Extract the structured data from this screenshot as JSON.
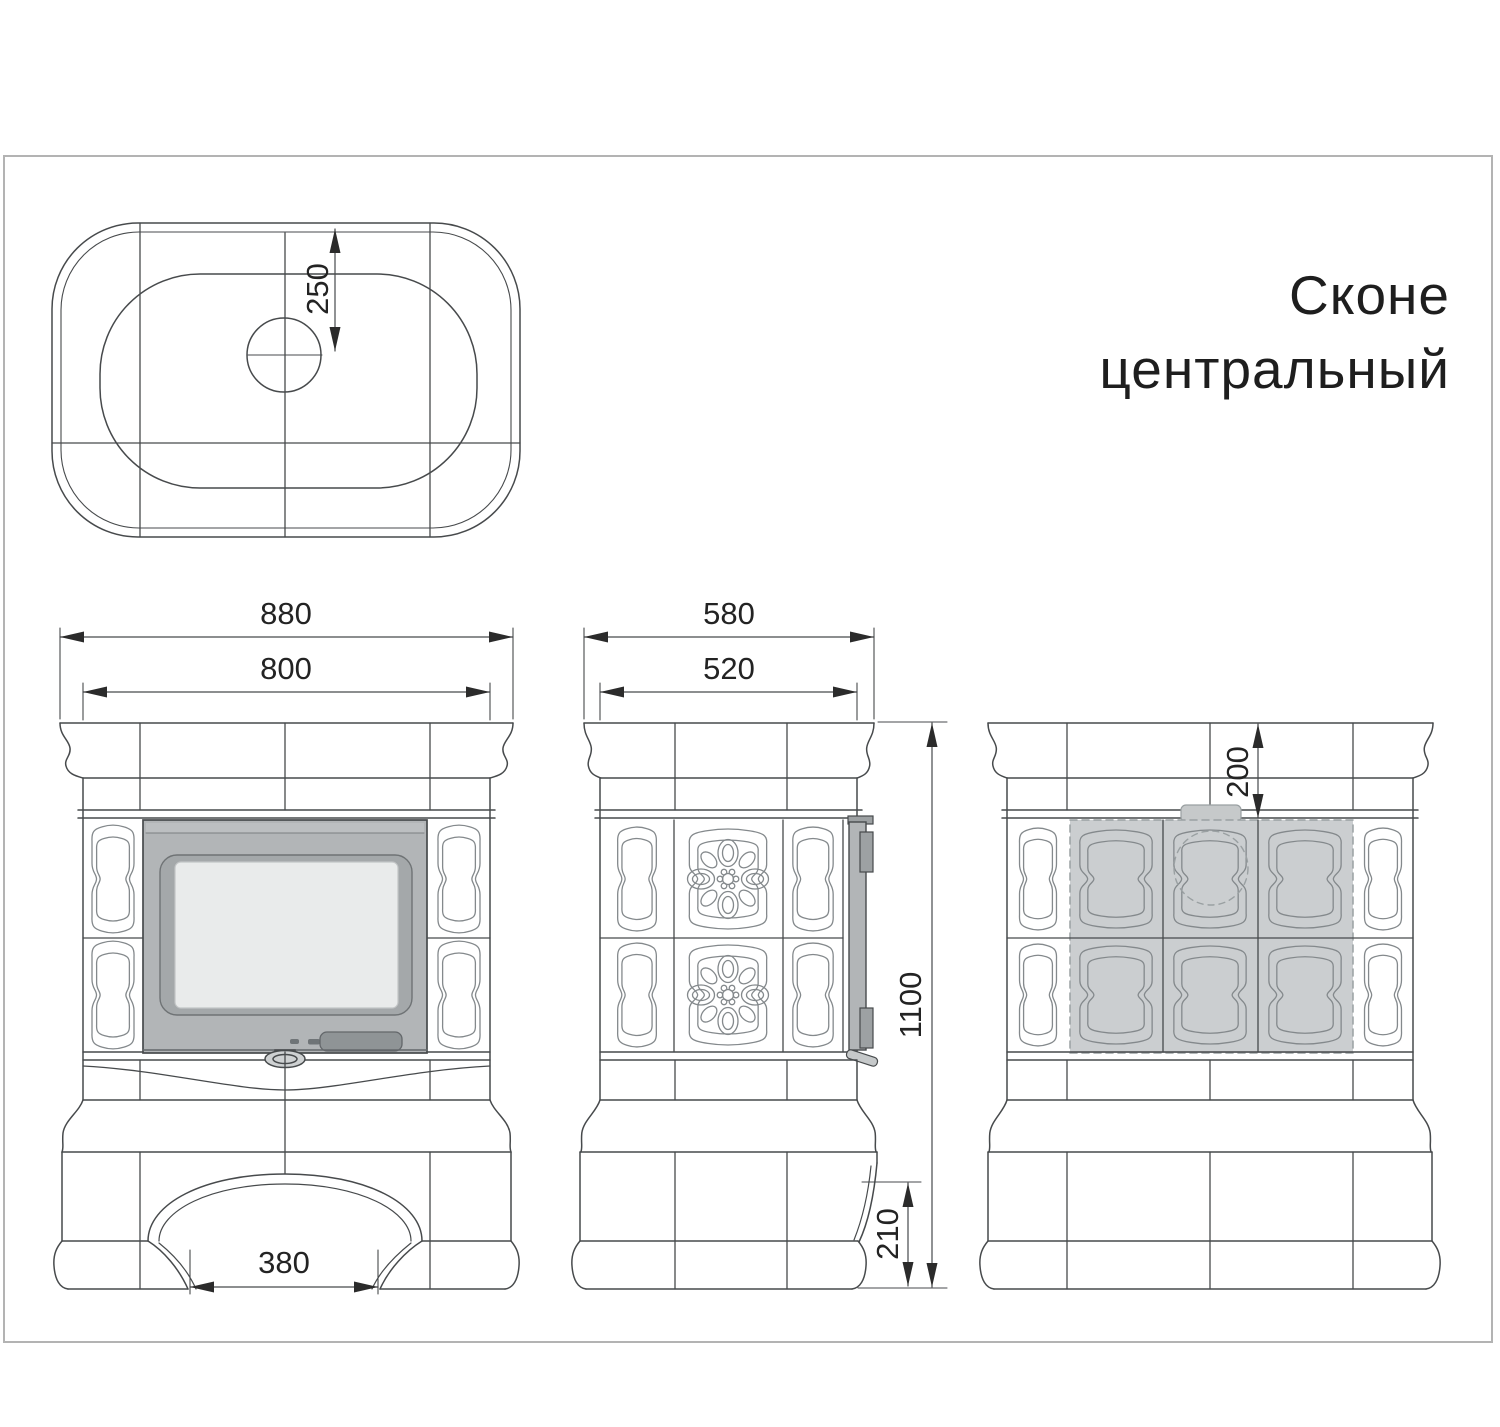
{
  "title": {
    "line1": "Сконе",
    "line2": "центральный"
  },
  "drawing": {
    "views": {
      "top": {
        "dims": {
          "flue_center_offset": "250"
        }
      },
      "front": {
        "dims": {
          "overall_width": "880",
          "body_width": "800",
          "arch_width": "380"
        }
      },
      "side": {
        "dims": {
          "overall_depth": "580",
          "body_depth": "520",
          "height": "1100",
          "rear_clearance": "210"
        }
      },
      "back": {
        "dims": {
          "flue_drop": "200"
        }
      }
    }
  },
  "colors": {
    "line": "#474a4c",
    "thin": "#84898c",
    "frame": "#b3b3b3",
    "door_fill": "#b2b5b7",
    "door_trim": "#9da1a3",
    "glass_frame": "#a4a8aa",
    "glass_fill": "#e9ebeb",
    "handle_fill": "#8f9496",
    "knob_fill": "#ced1d2",
    "shaded_fill": "#cbced0",
    "shaded_stroke": "#9aa0a2",
    "ornament": "#84898c",
    "arrow": "#2b2b2b"
  }
}
